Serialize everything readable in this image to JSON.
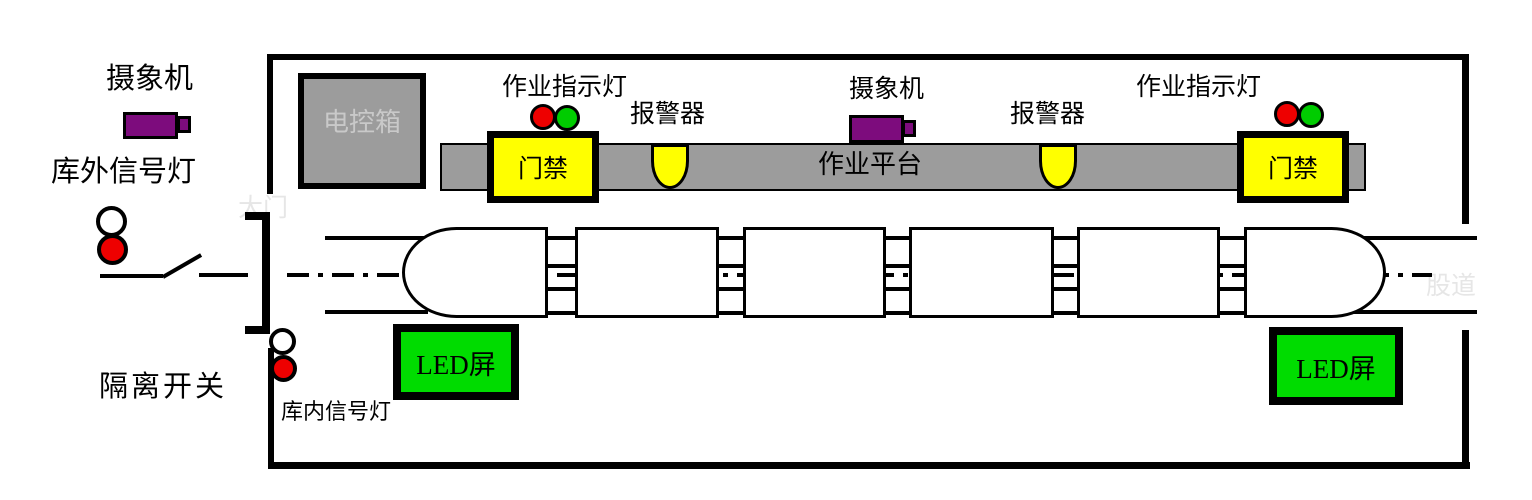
{
  "labels": {
    "camera_left": "摄象机",
    "outside_signal": "库外信号灯",
    "isolation_switch": "隔离开关",
    "inside_signal": "库内信号灯",
    "gate_faint": "大门",
    "track_faint": "股道",
    "control_box": "电控箱",
    "indicator_left": "作业指示灯",
    "indicator_right": "作业指示灯",
    "alarm_left": "报警器",
    "alarm_right": "报警器",
    "camera_mid": "摄象机",
    "platform": "作业平台",
    "access_left": "门禁",
    "access_right": "门禁",
    "led_left": "LED屏",
    "led_right": "LED屏"
  },
  "colors": {
    "platform_gray": "#9c9c9c",
    "device_yellow": "#ffff00",
    "led_green": "#00dc00",
    "signal_red": "#ee0000",
    "indicator_green": "#00cc00",
    "camera_purple": "#7d0c7d",
    "outline_black": "#000000",
    "faint_text": "#e6e6e6",
    "control_box_text": "#c9c9c9"
  }
}
